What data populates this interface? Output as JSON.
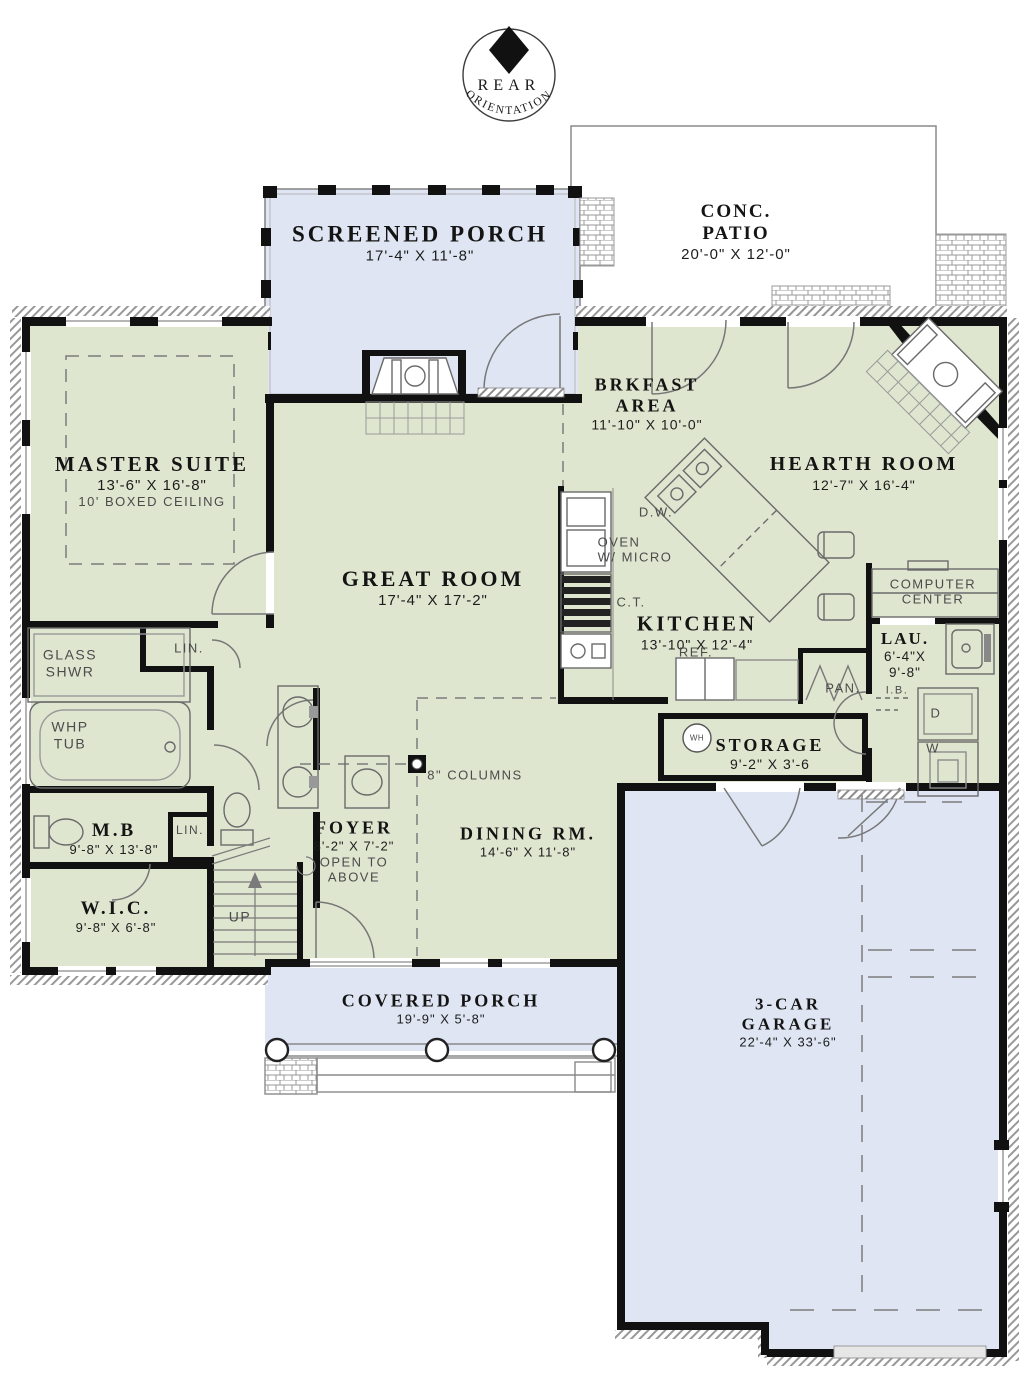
{
  "compass": {
    "top": "REAR",
    "arc": "ORIENTATION"
  },
  "rooms": {
    "screened_porch": {
      "name": "SCREENED PORCH",
      "dims": "17'-4\" X 11'-8\""
    },
    "conc_patio": {
      "name1": "CONC.",
      "name2": "PATIO",
      "dims": "20'-0\" X 12'-0\""
    },
    "master_suite": {
      "name": "MASTER SUITE",
      "dims": "13'-6\" X 16'-8\"",
      "note": "10' BOXED CEILING"
    },
    "great_room": {
      "name": "GREAT ROOM",
      "dims": "17'-4\" X 17'-2\""
    },
    "brkfast_area": {
      "name1": "BRKFAST",
      "name2": "AREA",
      "dims": "11'-10\" X 10'-0\""
    },
    "hearth_room": {
      "name": "HEARTH ROOM",
      "dims": "12'-7\" X 16'-4\""
    },
    "kitchen": {
      "name": "KITCHEN",
      "dims": "13'-10\" X 12'-4\""
    },
    "computer_center": {
      "line1": "COMPUTER",
      "line2": "CENTER"
    },
    "laundry": {
      "name": "LAU.",
      "dims1": "6'-4\"X",
      "dims2": "9'-8\""
    },
    "storage": {
      "name": "STORAGE",
      "dims": "9'-2\" X 3'-6"
    },
    "foyer": {
      "name": "FOYER",
      "dims": "8'-2\" X 7'-2\"",
      "note1": "OPEN TO",
      "note2": "ABOVE"
    },
    "dining": {
      "name": "DINING RM.",
      "dims": "14'-6\" X 11'-8\""
    },
    "mb": {
      "name": "M.B",
      "dims": "9'-8\" X 13'-8\""
    },
    "wic": {
      "name": "W.I.C.",
      "dims": "9'-8\" X 6'-8\""
    },
    "covered_porch": {
      "name": "COVERED PORCH",
      "dims": "19'-9\" X 5'-8\""
    },
    "garage": {
      "name1": "3-CAR",
      "name2": "GARAGE",
      "dims": "22'-4\" X 33'-6\""
    }
  },
  "fixtures": {
    "dw": "D.W.",
    "oven1": "OVEN",
    "oven2": "W/ MICRO",
    "ct": "C.T.",
    "ref": "REF.",
    "pan": "PAN.",
    "ib": "I.B.",
    "dryer": "D",
    "washer": "W",
    "wh": "WH",
    "glass1": "GLASS",
    "glass2": "SHWR",
    "whp1": "WHP",
    "whp2": "TUB",
    "lin1": "LIN.",
    "lin2": "LIN.",
    "up": "UP",
    "columns": "8\" COLUMNS"
  },
  "colors": {
    "room_fill": "#dfe6d0",
    "porch_fill": "#dfe5f3",
    "wall": "#111111"
  }
}
